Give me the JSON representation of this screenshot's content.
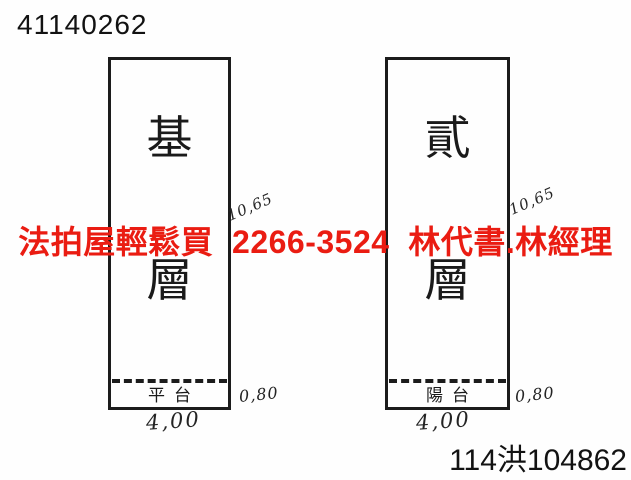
{
  "page": {
    "doc_number": "41140262",
    "case_number": "114洪104862",
    "watermark": {
      "text": "法拍屋輕鬆買  2266-3524  林代書.林經理",
      "color": "#ea1c12"
    },
    "floors": [
      {
        "name": "基層",
        "char_top": "基",
        "char_bottom": "層",
        "strip_label": "平台",
        "height_dim": "10,65",
        "strip_dim": "0,80",
        "width_dim": "4,00"
      },
      {
        "name": "貳層",
        "char_top": "貳",
        "char_bottom": "層",
        "strip_label": "陽台",
        "height_dim": "10,65",
        "strip_dim": "0,80",
        "width_dim": "4,00"
      }
    ]
  }
}
